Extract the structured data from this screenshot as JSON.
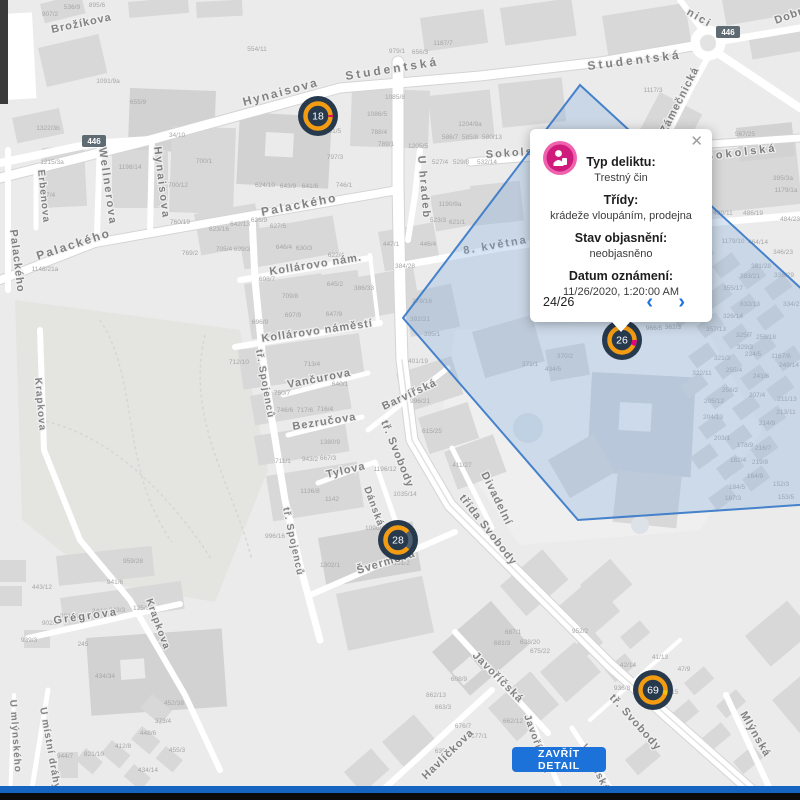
{
  "popup": {
    "close_glyph": "✕",
    "prev_glyph": "‹",
    "next_glyph": "›",
    "pagination": "24/26",
    "icon": "crime-category-icon",
    "icon_color": "#cf1b7b",
    "fields": [
      {
        "label": "Typ deliktu:",
        "value": "Trestný čin"
      },
      {
        "label": "Třídy:",
        "value": "krádeže vloupáním, prodejna"
      },
      {
        "label": "Stav objasnění:",
        "value": "neobjasněno"
      },
      {
        "label": "Datum oznámení:",
        "value": "11/26/2020, 1:20:00 AM"
      }
    ]
  },
  "detail_button": {
    "label": "ZAVŘÍT DETAIL"
  },
  "markers": [
    {
      "value": "18"
    },
    {
      "value": "26"
    },
    {
      "value": "28"
    },
    {
      "value": "69"
    }
  ],
  "colors": {
    "marker_bg": "#26394d",
    "marker_ring": "#f39c12",
    "marker_pink": "#e5007d",
    "marker_yellow": "#f1c40f",
    "polygon_stroke": "#3d7cc9",
    "polygon_fill": "#7fa8d9",
    "button_blue": "#1c72d8",
    "chevron_blue": "#1a73e8"
  },
  "map": {
    "road_badges": [
      {
        "text": "446"
      },
      {
        "text": "446"
      }
    ],
    "street_labels": [
      {
        "t": "Brožíkova",
        "x": 52,
        "y": 33,
        "r": -12,
        "s": 11,
        "ls": 1
      },
      {
        "t": "Hynaisova",
        "x": 244,
        "y": 106,
        "r": -15,
        "s": 12,
        "ls": 2
      },
      {
        "t": "Studentská",
        "x": 346,
        "y": 80,
        "r": -9,
        "s": 12,
        "ls": 3
      },
      {
        "t": "Studentská",
        "x": 588,
        "y": 70,
        "r": -7,
        "s": 12,
        "ls": 3
      },
      {
        "t": "Dobrovského",
        "x": 776,
        "y": 24,
        "r": -20,
        "s": 11,
        "ls": 1
      },
      {
        "t": "nici",
        "x": 686,
        "y": 14,
        "r": 30,
        "s": 11,
        "ls": 2
      },
      {
        "t": "Wellnerova",
        "x": 99,
        "y": 148,
        "r": 82,
        "s": 11,
        "ls": 2
      },
      {
        "t": "Hynaisova",
        "x": 154,
        "y": 147,
        "r": 83,
        "s": 11,
        "ls": 2
      },
      {
        "t": "Erbenova",
        "x": 38,
        "y": 170,
        "r": 84,
        "s": 10,
        "ls": 1
      },
      {
        "t": "Palackého",
        "x": 10,
        "y": 230,
        "r": 83,
        "s": 11,
        "ls": 1
      },
      {
        "t": "Palackého",
        "x": 38,
        "y": 260,
        "r": -18,
        "s": 12,
        "ls": 2
      },
      {
        "t": "Palackého",
        "x": 262,
        "y": 216,
        "r": -11,
        "s": 12,
        "ls": 2
      },
      {
        "t": "Sokolská",
        "x": 486,
        "y": 158,
        "r": -4,
        "s": 11,
        "ls": 2
      },
      {
        "t": "Sokolská",
        "x": 706,
        "y": 160,
        "r": -7,
        "s": 11,
        "ls": 3
      },
      {
        "t": "Zámečnická",
        "x": 666,
        "y": 134,
        "r": -63,
        "s": 11,
        "ls": 1
      },
      {
        "t": "U hradeb",
        "x": 418,
        "y": 156,
        "r": 85,
        "s": 11,
        "ls": 2
      },
      {
        "t": "8. května",
        "x": 464,
        "y": 254,
        "r": -10,
        "s": 11,
        "ls": 2
      },
      {
        "t": "Kollárovo nám.",
        "x": 270,
        "y": 275,
        "r": -9,
        "s": 11,
        "ls": 1
      },
      {
        "t": "Kollárovo náměstí",
        "x": 262,
        "y": 342,
        "r": -8,
        "s": 11,
        "ls": 1
      },
      {
        "t": "Vančurova",
        "x": 288,
        "y": 388,
        "r": -11,
        "s": 11,
        "ls": 1
      },
      {
        "t": "Bezručova",
        "x": 293,
        "y": 430,
        "r": -9,
        "s": 11,
        "ls": 1
      },
      {
        "t": "Tylova",
        "x": 327,
        "y": 478,
        "r": -13,
        "s": 11,
        "ls": 1
      },
      {
        "t": "Dánská",
        "x": 364,
        "y": 488,
        "r": 70,
        "s": 10,
        "ls": 1
      },
      {
        "t": "tř. Spojenců",
        "x": 256,
        "y": 350,
        "r": 80,
        "s": 10,
        "ls": 1
      },
      {
        "t": "tř. Spojenců",
        "x": 283,
        "y": 508,
        "r": 78,
        "s": 10,
        "ls": 1
      },
      {
        "t": "Švermova",
        "x": 358,
        "y": 574,
        "r": -17,
        "s": 11,
        "ls": 1
      },
      {
        "t": "tř. Svobody",
        "x": 381,
        "y": 422,
        "r": 68,
        "s": 11,
        "ls": 1
      },
      {
        "t": "třída Svobody",
        "x": 459,
        "y": 498,
        "r": 52,
        "s": 11,
        "ls": 1
      },
      {
        "t": "tř. Svobody",
        "x": 609,
        "y": 698,
        "r": 48,
        "s": 11,
        "ls": 1
      },
      {
        "t": "Barvířská",
        "x": 384,
        "y": 410,
        "r": -25,
        "s": 11,
        "ls": 1
      },
      {
        "t": "Divadelní",
        "x": 481,
        "y": 474,
        "r": 64,
        "s": 11,
        "ls": 1
      },
      {
        "t": "Javoříčská",
        "x": 472,
        "y": 656,
        "r": 45,
        "s": 11,
        "ls": 1
      },
      {
        "t": "Javoříčská",
        "x": 524,
        "y": 716,
        "r": 70,
        "s": 10,
        "ls": 1
      },
      {
        "t": "Havlíčkova",
        "x": 426,
        "y": 780,
        "r": -44,
        "s": 11,
        "ls": 1
      },
      {
        "t": "Vídeňská",
        "x": 581,
        "y": 746,
        "r": 63,
        "s": 10,
        "ls": 1
      },
      {
        "t": "Mlýnská",
        "x": 740,
        "y": 714,
        "r": 60,
        "s": 11,
        "ls": 1
      },
      {
        "t": "Grégrova",
        "x": 54,
        "y": 624,
        "r": -8,
        "s": 11,
        "ls": 2
      },
      {
        "t": "Krapkova",
        "x": 35,
        "y": 378,
        "r": 85,
        "s": 10,
        "ls": 1
      },
      {
        "t": "Krapkova",
        "x": 146,
        "y": 600,
        "r": 70,
        "s": 10,
        "ls": 1
      },
      {
        "t": "U místní dráhy",
        "x": 40,
        "y": 708,
        "r": 80,
        "s": 10,
        "ls": 1
      },
      {
        "t": "U mlýnského",
        "x": 10,
        "y": 700,
        "r": 86,
        "s": 10,
        "ls": 1
      }
    ],
    "house_numbers": [
      {
        "t": "907/2",
        "x": 50,
        "y": 16
      },
      {
        "t": "536/9",
        "x": 72,
        "y": 9
      },
      {
        "t": "895/6",
        "x": 97,
        "y": 7
      },
      {
        "t": "554/11",
        "x": 257,
        "y": 51
      },
      {
        "t": "979/1",
        "x": 397,
        "y": 53
      },
      {
        "t": "656/3",
        "x": 420,
        "y": 54
      },
      {
        "t": "1187/7",
        "x": 443,
        "y": 45
      },
      {
        "t": "1091/9a",
        "x": 108,
        "y": 83
      },
      {
        "t": "655/9",
        "x": 138,
        "y": 104
      },
      {
        "t": "1322/3b",
        "x": 48,
        "y": 130
      },
      {
        "t": "1215/3a",
        "x": 52,
        "y": 164
      },
      {
        "t": "167/4",
        "x": 47,
        "y": 197
      },
      {
        "t": "1198/14",
        "x": 130,
        "y": 169
      },
      {
        "t": "34/10",
        "x": 177,
        "y": 137
      },
      {
        "t": "700/1",
        "x": 204,
        "y": 163
      },
      {
        "t": "700/12",
        "x": 178,
        "y": 187
      },
      {
        "t": "760/19",
        "x": 180,
        "y": 224
      },
      {
        "t": "623/16",
        "x": 219,
        "y": 231
      },
      {
        "t": "705/4",
        "x": 224,
        "y": 251
      },
      {
        "t": "769/2",
        "x": 190,
        "y": 255
      },
      {
        "t": "1148/21a",
        "x": 45,
        "y": 271
      },
      {
        "t": "1085/8",
        "x": 395,
        "y": 99
      },
      {
        "t": "1086/5",
        "x": 377,
        "y": 116
      },
      {
        "t": "788/4",
        "x": 379,
        "y": 134
      },
      {
        "t": "789/1",
        "x": 386,
        "y": 146
      },
      {
        "t": "791/5",
        "x": 333,
        "y": 133
      },
      {
        "t": "797/3",
        "x": 335,
        "y": 159
      },
      {
        "t": "746/1",
        "x": 344,
        "y": 187
      },
      {
        "t": "624/10",
        "x": 265,
        "y": 187
      },
      {
        "t": "643/9",
        "x": 288,
        "y": 188
      },
      {
        "t": "641/6",
        "x": 310,
        "y": 188
      },
      {
        "t": "1204/9a",
        "x": 470,
        "y": 126
      },
      {
        "t": "1205/5",
        "x": 418,
        "y": 148
      },
      {
        "t": "586/7",
        "x": 450,
        "y": 139
      },
      {
        "t": "585/8",
        "x": 470,
        "y": 139
      },
      {
        "t": "580/13",
        "x": 492,
        "y": 139
      },
      {
        "t": "527/4",
        "x": 440,
        "y": 164
      },
      {
        "t": "529/8",
        "x": 461,
        "y": 164
      },
      {
        "t": "532/14",
        "x": 487,
        "y": 164
      },
      {
        "t": "1190/9a",
        "x": 450,
        "y": 206
      },
      {
        "t": "523/3",
        "x": 438,
        "y": 222
      },
      {
        "t": "621/1",
        "x": 457,
        "y": 224
      },
      {
        "t": "642/13",
        "x": 240,
        "y": 226
      },
      {
        "t": "626/9",
        "x": 259,
        "y": 222
      },
      {
        "t": "627/5",
        "x": 278,
        "y": 228
      },
      {
        "t": "699/3",
        "x": 242,
        "y": 251
      },
      {
        "t": "646/4",
        "x": 284,
        "y": 249
      },
      {
        "t": "630/3",
        "x": 304,
        "y": 250
      },
      {
        "t": "622/4",
        "x": 336,
        "y": 257
      },
      {
        "t": "698/7",
        "x": 267,
        "y": 281
      },
      {
        "t": "709/8",
        "x": 290,
        "y": 298
      },
      {
        "t": "645/2",
        "x": 335,
        "y": 286
      },
      {
        "t": "697/9",
        "x": 293,
        "y": 317
      },
      {
        "t": "696/9",
        "x": 260,
        "y": 324
      },
      {
        "t": "647/9",
        "x": 334,
        "y": 316
      },
      {
        "t": "712/10",
        "x": 239,
        "y": 364
      },
      {
        "t": "713/4",
        "x": 312,
        "y": 366
      },
      {
        "t": "447/1",
        "x": 391,
        "y": 246
      },
      {
        "t": "446/4",
        "x": 428,
        "y": 246
      },
      {
        "t": "384/28",
        "x": 405,
        "y": 268
      },
      {
        "t": "386/33",
        "x": 364,
        "y": 290
      },
      {
        "t": "279/16",
        "x": 422,
        "y": 303
      },
      {
        "t": "392/21",
        "x": 420,
        "y": 321
      },
      {
        "t": "395/1",
        "x": 432,
        "y": 336
      },
      {
        "t": "401/19",
        "x": 418,
        "y": 363
      },
      {
        "t": "750/7",
        "x": 282,
        "y": 395
      },
      {
        "t": "746/6",
        "x": 285,
        "y": 412
      },
      {
        "t": "717/6",
        "x": 305,
        "y": 412
      },
      {
        "t": "716/4",
        "x": 325,
        "y": 411
      },
      {
        "t": "640/1",
        "x": 340,
        "y": 386
      },
      {
        "t": "996/21",
        "x": 420,
        "y": 403
      },
      {
        "t": "615/25",
        "x": 432,
        "y": 433
      },
      {
        "t": "411/27",
        "x": 462,
        "y": 467
      },
      {
        "t": "1380/9",
        "x": 330,
        "y": 444
      },
      {
        "t": "711/1",
        "x": 283,
        "y": 463
      },
      {
        "t": "943/2",
        "x": 310,
        "y": 461
      },
      {
        "t": "667/3",
        "x": 328,
        "y": 460
      },
      {
        "t": "1196/12",
        "x": 385,
        "y": 471
      },
      {
        "t": "1035/14",
        "x": 405,
        "y": 496
      },
      {
        "t": "1136/8",
        "x": 310,
        "y": 493
      },
      {
        "t": "1142",
        "x": 332,
        "y": 501
      },
      {
        "t": "996/16",
        "x": 275,
        "y": 538
      },
      {
        "t": "1302/1",
        "x": 330,
        "y": 567
      },
      {
        "t": "1161/2",
        "x": 400,
        "y": 565
      },
      {
        "t": "1096/4",
        "x": 375,
        "y": 530
      },
      {
        "t": "1117/3",
        "x": 653,
        "y": 92
      },
      {
        "t": "567/25",
        "x": 745,
        "y": 136
      },
      {
        "t": "395/3a",
        "x": 783,
        "y": 180
      },
      {
        "t": "1179/1a",
        "x": 786,
        "y": 192
      },
      {
        "t": "499/11",
        "x": 723,
        "y": 215
      },
      {
        "t": "486/19",
        "x": 753,
        "y": 215
      },
      {
        "t": "484/23",
        "x": 790,
        "y": 221
      },
      {
        "t": "966/5",
        "x": 654,
        "y": 330
      },
      {
        "t": "362/3",
        "x": 673,
        "y": 329
      },
      {
        "t": "370/2",
        "x": 565,
        "y": 358
      },
      {
        "t": "371/1",
        "x": 530,
        "y": 366
      },
      {
        "t": "434/5",
        "x": 553,
        "y": 371
      },
      {
        "t": "1179/10",
        "x": 733,
        "y": 243
      },
      {
        "t": "464/14",
        "x": 758,
        "y": 244
      },
      {
        "t": "346/23",
        "x": 783,
        "y": 254
      },
      {
        "t": "381/28",
        "x": 761,
        "y": 268
      },
      {
        "t": "383/21",
        "x": 750,
        "y": 278
      },
      {
        "t": "336/29",
        "x": 784,
        "y": 277
      },
      {
        "t": "355/17",
        "x": 733,
        "y": 290
      },
      {
        "t": "832/13",
        "x": 750,
        "y": 306
      },
      {
        "t": "334/27",
        "x": 793,
        "y": 306
      },
      {
        "t": "326/14",
        "x": 733,
        "y": 318
      },
      {
        "t": "357/13",
        "x": 716,
        "y": 331
      },
      {
        "t": "325/7",
        "x": 744,
        "y": 337
      },
      {
        "t": "256/18",
        "x": 766,
        "y": 339
      },
      {
        "t": "329/3",
        "x": 745,
        "y": 349
      },
      {
        "t": "234/5",
        "x": 753,
        "y": 356
      },
      {
        "t": "1167/6",
        "x": 781,
        "y": 358
      },
      {
        "t": "321/3",
        "x": 722,
        "y": 360
      },
      {
        "t": "249/14",
        "x": 789,
        "y": 367
      },
      {
        "t": "322/11",
        "x": 702,
        "y": 375
      },
      {
        "t": "255/4",
        "x": 734,
        "y": 372
      },
      {
        "t": "241/6",
        "x": 761,
        "y": 378
      },
      {
        "t": "256/2",
        "x": 730,
        "y": 392
      },
      {
        "t": "207/4",
        "x": 757,
        "y": 397
      },
      {
        "t": "211/13",
        "x": 787,
        "y": 401
      },
      {
        "t": "205/12",
        "x": 714,
        "y": 403
      },
      {
        "t": "204/13",
        "x": 713,
        "y": 419
      },
      {
        "t": "213/11",
        "x": 786,
        "y": 414
      },
      {
        "t": "214/9",
        "x": 767,
        "y": 425
      },
      {
        "t": "203/1",
        "x": 722,
        "y": 440
      },
      {
        "t": "178/9",
        "x": 745,
        "y": 447
      },
      {
        "t": "216/7",
        "x": 763,
        "y": 450
      },
      {
        "t": "182/4",
        "x": 738,
        "y": 462
      },
      {
        "t": "219/8",
        "x": 760,
        "y": 464
      },
      {
        "t": "164/9",
        "x": 755,
        "y": 478
      },
      {
        "t": "184/5",
        "x": 737,
        "y": 489
      },
      {
        "t": "152/3",
        "x": 781,
        "y": 486
      },
      {
        "t": "187/3",
        "x": 733,
        "y": 500
      },
      {
        "t": "153/5",
        "x": 786,
        "y": 499
      },
      {
        "t": "941/6",
        "x": 115,
        "y": 584
      },
      {
        "t": "959/28",
        "x": 133,
        "y": 563
      },
      {
        "t": "443/12",
        "x": 42,
        "y": 589
      },
      {
        "t": "244/3",
        "x": 100,
        "y": 613
      },
      {
        "t": "243/3",
        "x": 117,
        "y": 612
      },
      {
        "t": "125/30",
        "x": 143,
        "y": 610
      },
      {
        "t": "981/7a",
        "x": 70,
        "y": 618
      },
      {
        "t": "902/9",
        "x": 50,
        "y": 625
      },
      {
        "t": "939/3",
        "x": 29,
        "y": 642
      },
      {
        "t": "245",
        "x": 83,
        "y": 646
      },
      {
        "t": "434/34",
        "x": 105,
        "y": 678
      },
      {
        "t": "452/38",
        "x": 174,
        "y": 705
      },
      {
        "t": "373/4",
        "x": 163,
        "y": 723
      },
      {
        "t": "448/6",
        "x": 148,
        "y": 735
      },
      {
        "t": "412/8",
        "x": 123,
        "y": 748
      },
      {
        "t": "455/3",
        "x": 177,
        "y": 752
      },
      {
        "t": "944/7",
        "x": 65,
        "y": 758
      },
      {
        "t": "821/10",
        "x": 94,
        "y": 756
      },
      {
        "t": "434/14",
        "x": 148,
        "y": 772
      },
      {
        "t": "687/1",
        "x": 513,
        "y": 634
      },
      {
        "t": "681/3",
        "x": 502,
        "y": 645
      },
      {
        "t": "638/20",
        "x": 530,
        "y": 644
      },
      {
        "t": "675/22",
        "x": 540,
        "y": 653
      },
      {
        "t": "952/2",
        "x": 580,
        "y": 633
      },
      {
        "t": "608/9",
        "x": 459,
        "y": 681
      },
      {
        "t": "862/13",
        "x": 436,
        "y": 697
      },
      {
        "t": "663/3",
        "x": 443,
        "y": 709
      },
      {
        "t": "676/7",
        "x": 463,
        "y": 728
      },
      {
        "t": "677/1",
        "x": 479,
        "y": 738
      },
      {
        "t": "662/12",
        "x": 513,
        "y": 723
      },
      {
        "t": "635/4",
        "x": 443,
        "y": 753
      },
      {
        "t": "42/14",
        "x": 628,
        "y": 667
      },
      {
        "t": "41/13",
        "x": 660,
        "y": 659
      },
      {
        "t": "47/9",
        "x": 684,
        "y": 671
      },
      {
        "t": "936/8",
        "x": 622,
        "y": 690
      },
      {
        "t": "5/15",
        "x": 672,
        "y": 694
      }
    ]
  }
}
